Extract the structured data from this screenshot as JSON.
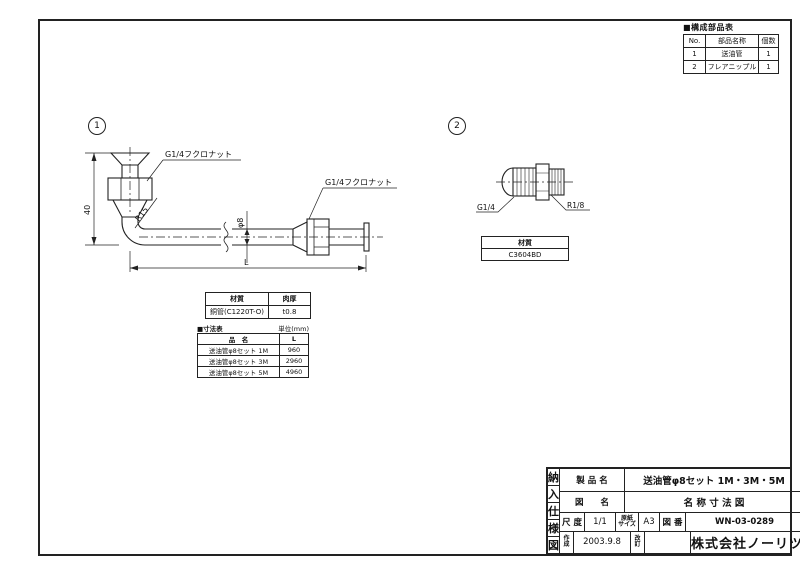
{
  "parts_table": {
    "title": "■構成部品表",
    "col_no": "No.",
    "col_name": "部品名称",
    "col_qty": "個数",
    "rows": [
      {
        "no": "1",
        "name": "送油管",
        "qty": "1"
      },
      {
        "no": "2",
        "name": "フレアニップル",
        "qty": "1"
      }
    ]
  },
  "item1": {
    "balloon": "1",
    "label_nut_top": "G1/4フクロナット",
    "label_nut_right": "G1/4フクロナット",
    "label_radius": "R15",
    "label_dia": "φ8",
    "dim_height": "40",
    "dim_length": "L",
    "material_table": {
      "h_material": "材質",
      "h_thickness": "肉厚",
      "material": "銅管(C1220T-O)",
      "thickness": "t0.8"
    },
    "dim_table": {
      "title": "■寸法表",
      "unit": "単位(mm)",
      "h_name": "品　名",
      "h_len": "L",
      "rows": [
        {
          "name": "送油管φ8セット 1M",
          "len": "960"
        },
        {
          "name": "送油管φ8セット 3M",
          "len": "2960"
        },
        {
          "name": "送油管φ8セット 5M",
          "len": "4960"
        }
      ]
    }
  },
  "item2": {
    "balloon": "2",
    "label_left": "G1/4",
    "label_right": "R1/8",
    "material_table": {
      "h_material": "材質",
      "material": "C3604BD"
    }
  },
  "title_block": {
    "side": [
      "納",
      "入",
      "仕",
      "様",
      "図"
    ],
    "r1_label": "製 品 名",
    "r1_value": "送油管φ8セット 1M・3M・5M",
    "r2_label": "図　　名",
    "r2_value": "名 称 寸 法 図",
    "scale_label": "尺 度",
    "scale": "1/1",
    "paper_label_1": "原紙",
    "paper_label_2": "サイズ",
    "paper": "A3",
    "no_label": "図 番",
    "no": "WN-03-0289",
    "made_label_1": "作",
    "made_label_2": "成",
    "made": "2003.9.8",
    "rev_label_1": "改",
    "rev_label_2": "訂",
    "company": "株式会社ノーリツ"
  }
}
